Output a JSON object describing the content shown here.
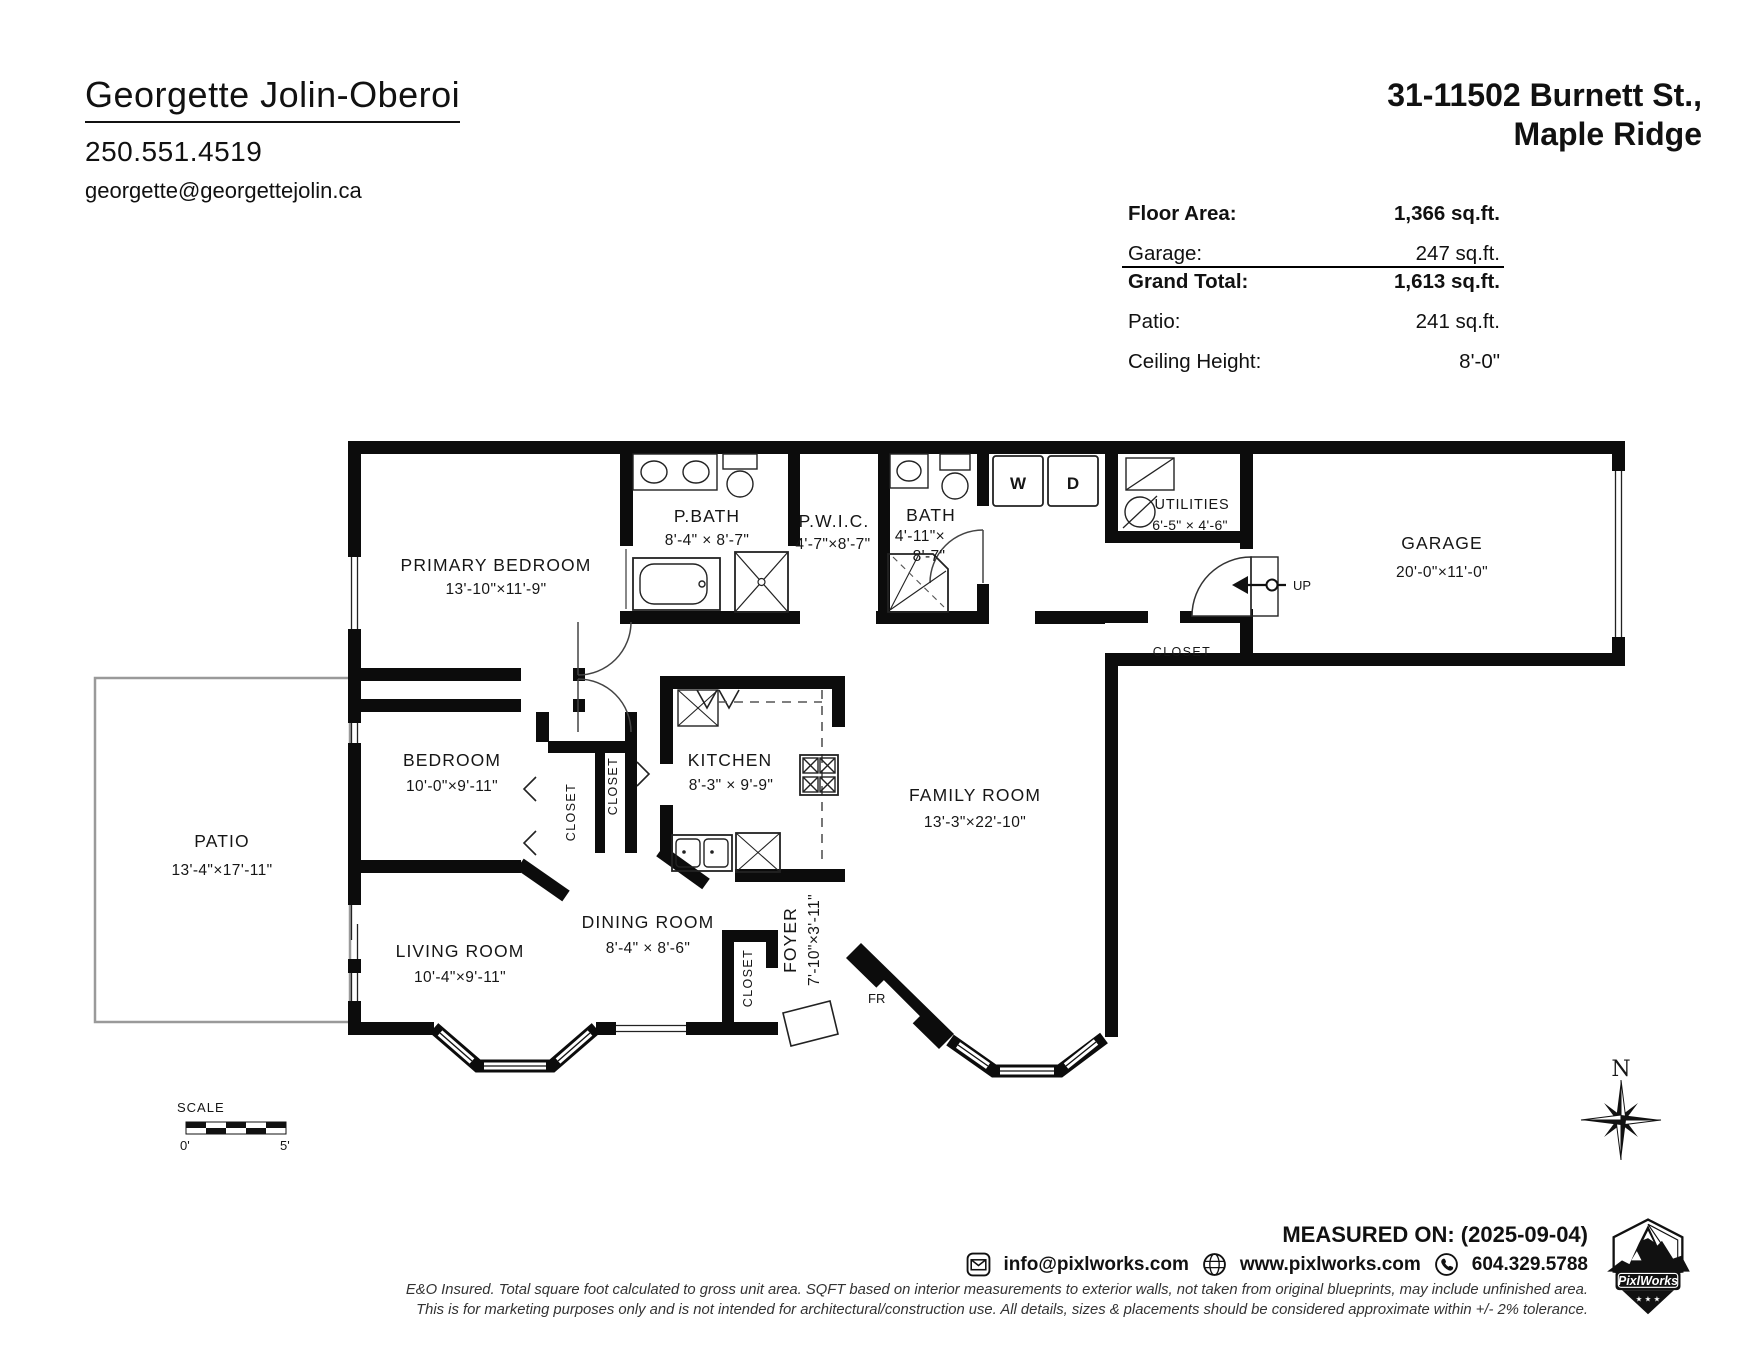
{
  "header": {
    "agent_name": "Georgette Jolin-Oberoi",
    "agent_phone": "250.551.4519",
    "agent_email": "georgette@georgettejolin.ca",
    "address_line1": "31-11502 Burnett St.,",
    "address_line2": "Maple Ridge"
  },
  "stats": {
    "rows": [
      {
        "label": "Floor Area:",
        "value": "1,366 sq.ft."
      },
      {
        "label": "Garage:",
        "value": "247 sq.ft."
      },
      {
        "label": "Grand Total:",
        "value": "1,613 sq.ft."
      },
      {
        "label": "Patio:",
        "value": "241 sq.ft."
      },
      {
        "label": "Ceiling Height:",
        "value": "8'-0\""
      }
    ]
  },
  "rooms": {
    "primary_bedroom": {
      "name": "PRIMARY BEDROOM",
      "dims": "13'-10\"×11'-9\""
    },
    "p_bath": {
      "name": "P.BATH",
      "dims": "8'-4\" × 8'-7\""
    },
    "pwic": {
      "name": "P.W.I.C.",
      "dims": "4'-7\"×8'-7\""
    },
    "bath": {
      "name": "BATH",
      "dims_line1": "4'-11\"×",
      "dims_line2": "8'-7\""
    },
    "utilities": {
      "name": "UTILITIES",
      "dims": "6'-5\" × 4'-6\""
    },
    "garage": {
      "name": "GARAGE",
      "dims": "20'-0\"×11'-0\""
    },
    "hall_closet": {
      "name": "CLOSET"
    },
    "bedroom": {
      "name": "BEDROOM",
      "dims": "10'-0\"×9'-11\""
    },
    "bedroom_closet": {
      "name": "CLOSET"
    },
    "hallway_closet": {
      "name": "CLOSET"
    },
    "kitchen": {
      "name": "KITCHEN",
      "dims": "8'-3\" × 9'-9\""
    },
    "family_room": {
      "name": "FAMILY ROOM",
      "dims": "13'-3\"×22'-10\""
    },
    "patio": {
      "name": "PATIO",
      "dims": "13'-4\"×17'-11\""
    },
    "living_room": {
      "name": "LIVING ROOM",
      "dims": "10'-4\"×9'-11\""
    },
    "dining_room": {
      "name": "DINING ROOM",
      "dims": "8'-4\" × 8'-6\""
    },
    "foyer": {
      "name": "FOYER",
      "dims": "7'-10\"×3'-11\""
    },
    "foyer_closet": {
      "name": "CLOSET"
    }
  },
  "plan_annotations": {
    "washer": "W",
    "dryer": "D",
    "up": "UP",
    "front_door": "FR",
    "north": "N",
    "scale_label": "SCALE",
    "scale_start": "0'",
    "scale_end": "5'"
  },
  "footer": {
    "measured_on": "MEASURED ON: (2025-09-04)",
    "contact_email": "info@pixlworks.com",
    "contact_website": "www.pixlworks.com",
    "contact_phone": "604.329.5788",
    "disclaimer_line1": "E&O Insured.  Total square foot calculated to gross unit area. SQFT based on interior measurements to exterior walls, not taken from original blueprints, may include unfinished area.",
    "disclaimer_line2": "This is for marketing purposes only and is not intended for architectural/construction use.  All details, sizes & placements should be considered approximate within +/- 2%  tolerance.",
    "logo_name": "PixlWorks",
    "logo_stars": "★ ★ ★"
  },
  "colors": {
    "wall": "#0c0c0c",
    "patio_outline": "#9a9a9a",
    "background": "#ffffff"
  }
}
